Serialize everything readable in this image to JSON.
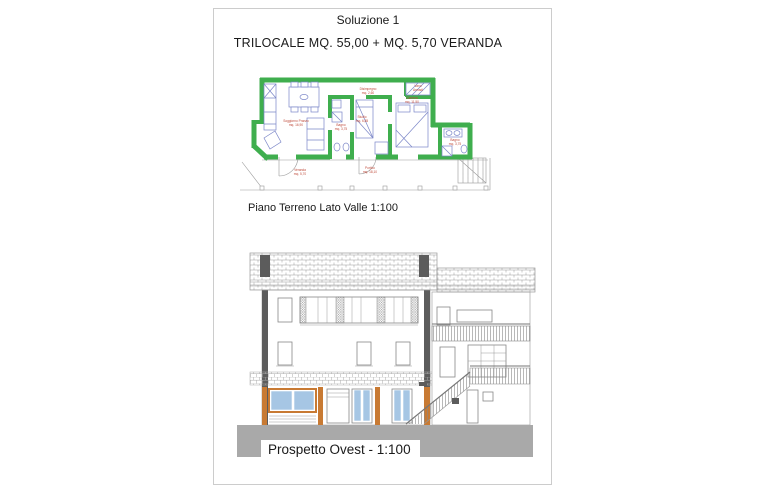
{
  "header": {
    "title": "Soluzione 1",
    "subtitle": "TRILOCALE MQ. 55,00 + MQ. 5,70 VERANDA"
  },
  "floor_plan": {
    "caption": "Piano Terreno Lato Valle 1:100",
    "rooms": {
      "soggiorno": {
        "name": "Soggiorno Pranzo",
        "area": "mq. 16,90"
      },
      "disimpegno": {
        "name": "Disimpegno",
        "area": "mq. 2,60"
      },
      "bagno1": {
        "name": "Bagno",
        "area": "mq. 3,75"
      },
      "studio": {
        "name": "Studio",
        "area": "mq. 6,85"
      },
      "camera": {
        "name": "Camera",
        "area": "mq. 11,50"
      },
      "vano_armadi": {
        "name": "Vano",
        "area": "Armadi"
      },
      "bagno2": {
        "name": "Bagno",
        "area": "mq. 3,75"
      },
      "veranda": {
        "name": "Veranda",
        "area": "mq. 5,70"
      },
      "portico": {
        "name": "Portico",
        "area": "mq. 18,10"
      }
    }
  },
  "elevation": {
    "label": "Prospetto Ovest - 1:100"
  },
  "colors": {
    "wall": "#3fae4e",
    "label": "#bf4a3a",
    "furn": "#7b86c8",
    "line": "#9a9a9a",
    "timber": "#c87a33",
    "glass": "#a6c6e4",
    "ground": "#a9a9a9",
    "dark": "#5c5c5c",
    "text": "#1a1a1a",
    "border": "#cccccc"
  }
}
